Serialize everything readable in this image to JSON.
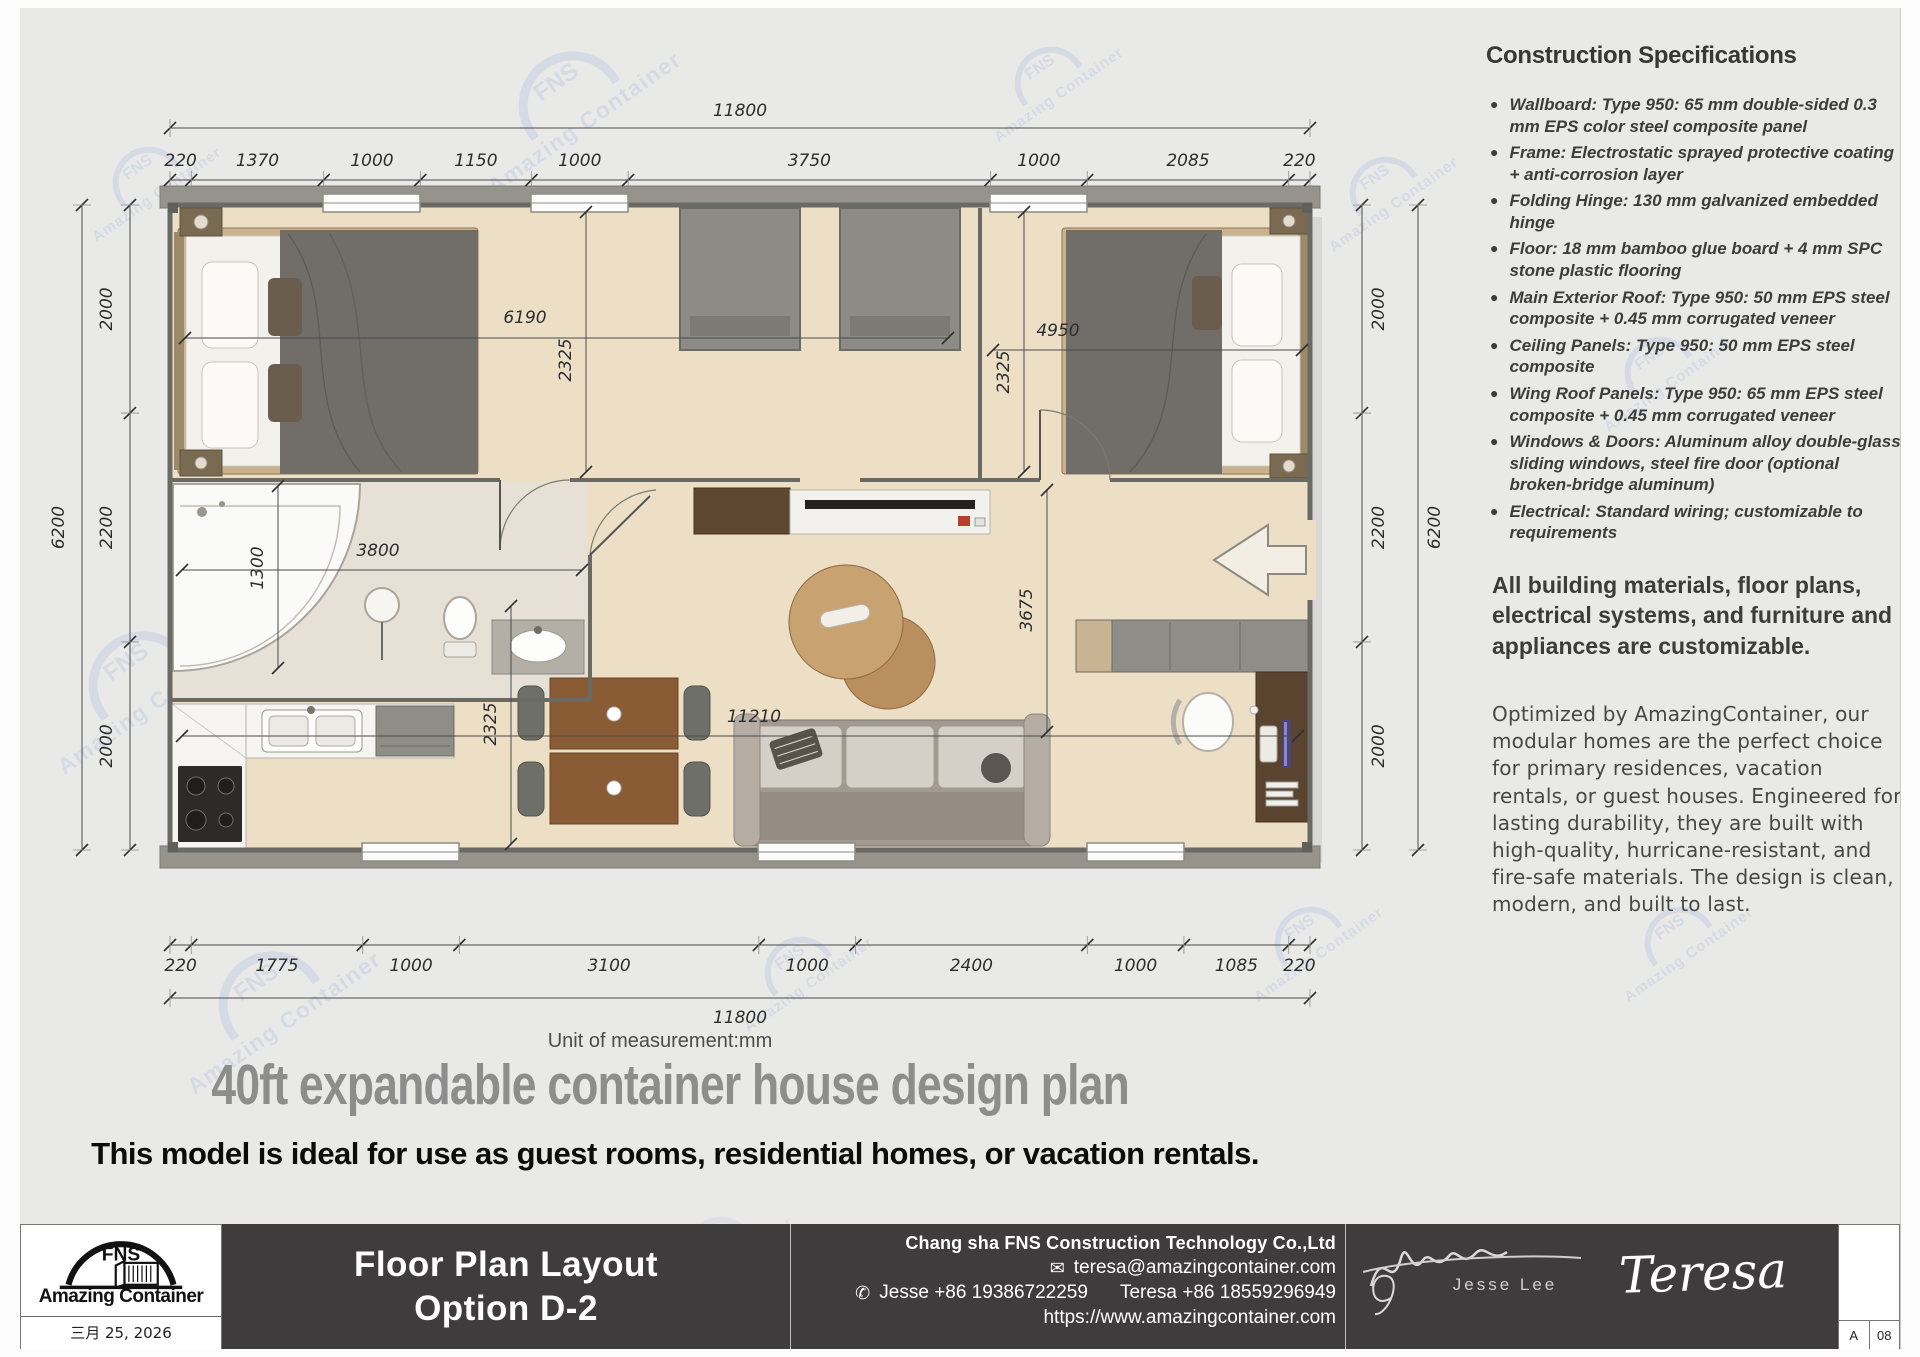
{
  "page": {
    "unit_note": "Unit of measurement:mm",
    "title": "40ft expandable container house design plan",
    "subtitle": "This model is ideal for use as guest rooms, residential homes, or vacation rentals."
  },
  "specs": {
    "heading": "Construction Specifications",
    "items": [
      "Wallboard: Type 950: 65 mm double-sided 0.3 mm EPS color steel composite panel",
      "Frame: Electrostatic sprayed protective coating + anti-corrosion layer",
      "Folding Hinge: 130 mm galvanized embedded hinge",
      "Floor: 18 mm bamboo glue board + 4 mm SPC stone plastic flooring",
      "Main Exterior Roof: Type 950: 50 mm EPS steel composite + 0.45 mm corrugated veneer",
      "Ceiling Panels: Type 950: 50 mm EPS steel composite",
      "Wing Roof Panels: Type 950: 65 mm EPS steel composite + 0.45 mm corrugated veneer",
      "Windows & Doors: Aluminum alloy double-glass sliding windows, steel fire door (optional broken-bridge aluminum)",
      "Electrical: Standard wiring; customizable to requirements"
    ],
    "customizable_note": "All building materials, floor plans, electrical systems, and furniture and appliances are customizable.",
    "marketing_note": "Optimized by AmazingContainer, our modular homes are the perfect choice for primary residences, vacation rentals, or guest houses. Engineered for lasting durability, they are built with high-quality, hurricane-resistant, and fire-safe materials. The design is clean, modern, and built to last."
  },
  "plan": {
    "overall_width": "11800",
    "bottom_overall": "11800",
    "overall_depth_left": "6200",
    "overall_depth_right": "6200",
    "top_chain": [
      "220",
      "1370",
      "1000",
      "1150",
      "1000",
      "3750",
      "1000",
      "2085",
      "220"
    ],
    "bottom_chain": [
      "220",
      "1775",
      "1000",
      "3100",
      "1000",
      "2400",
      "1000",
      "1085",
      "220"
    ],
    "left_chain": [
      "2000",
      "2200",
      "2000"
    ],
    "right_chain": [
      "2000",
      "2200",
      "2000"
    ],
    "interior": {
      "bedL_w": "6190",
      "bedL_d": "2325",
      "bedR_w": "4950",
      "bedR_d": "2325",
      "tub_w": "1300",
      "bath_w": "3800",
      "kitchen_d": "2325",
      "living_w": "11210",
      "hall_d": "3675"
    }
  },
  "footer": {
    "logo_fns": "FNS",
    "logo_text": "Amazing Container",
    "date": "三月 25, 2026",
    "sheet_title_line1": "Floor Plan Layout",
    "sheet_title_line2": "Option D-2",
    "company": "Chang sha FNS Construction Technology Co.,Ltd",
    "email": "teresa@amazingcontainer.com",
    "phone_jesse": "Jesse +86 19386722259",
    "phone_teresa": "Teresa  +86 18559296949",
    "website": "https://www.amazingcontainer.com",
    "signature_engineer": "Jesse Lee",
    "signature_sales": "Teresa",
    "rev": "A",
    "sheet_no": "08"
  },
  "watermark": {
    "line1": "FNS",
    "line2": "Amazing Container"
  },
  "colors": {
    "sheet_bg": "#e9e9e7",
    "floor_beige": "#ecdfc6",
    "roof_gray": "#95938c",
    "footer_dark": "#3e3c3d",
    "title_gray": "#8d8d8d",
    "watermark_blue": "#b0bddf"
  }
}
